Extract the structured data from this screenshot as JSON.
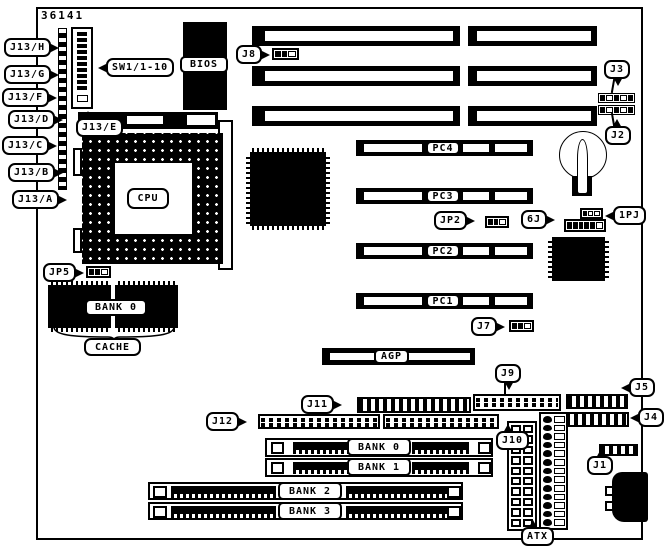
{
  "board": {
    "part_number": "36141"
  },
  "colors": {
    "ink": "#000000",
    "paper": "#ffffff"
  },
  "labels": {
    "j13h": "J13/H",
    "j13g": "J13/G",
    "j13f": "J13/F",
    "j13d": "J13/D",
    "j13c": "J13/C",
    "j13b": "J13/B",
    "j13a": "J13/A",
    "j13e": "J13/E",
    "sw1": "SW1/1-10",
    "bios": "BIOS",
    "cpu": "CPU",
    "j8": "J8",
    "j3": "J3",
    "j2": "J2",
    "pc4": "PC4",
    "pc3": "PC3",
    "pc2": "PC2",
    "pc1": "PC1",
    "jp2": "JP2",
    "j6": "6J",
    "jp1": "1PJ",
    "jp5": "JP5",
    "cache_bank0": "BANK 0",
    "cache": "CACHE",
    "j7": "J7",
    "agp": "AGP",
    "j9": "J9",
    "j11": "J11",
    "j12": "J12",
    "j10": "J10",
    "j5": "J5",
    "j4": "J4",
    "j1": "J1",
    "atx": "ATX",
    "bank0": "BANK 0",
    "bank1": "BANK 1",
    "bank2": "BANK 2",
    "bank3": "BANK 3"
  }
}
